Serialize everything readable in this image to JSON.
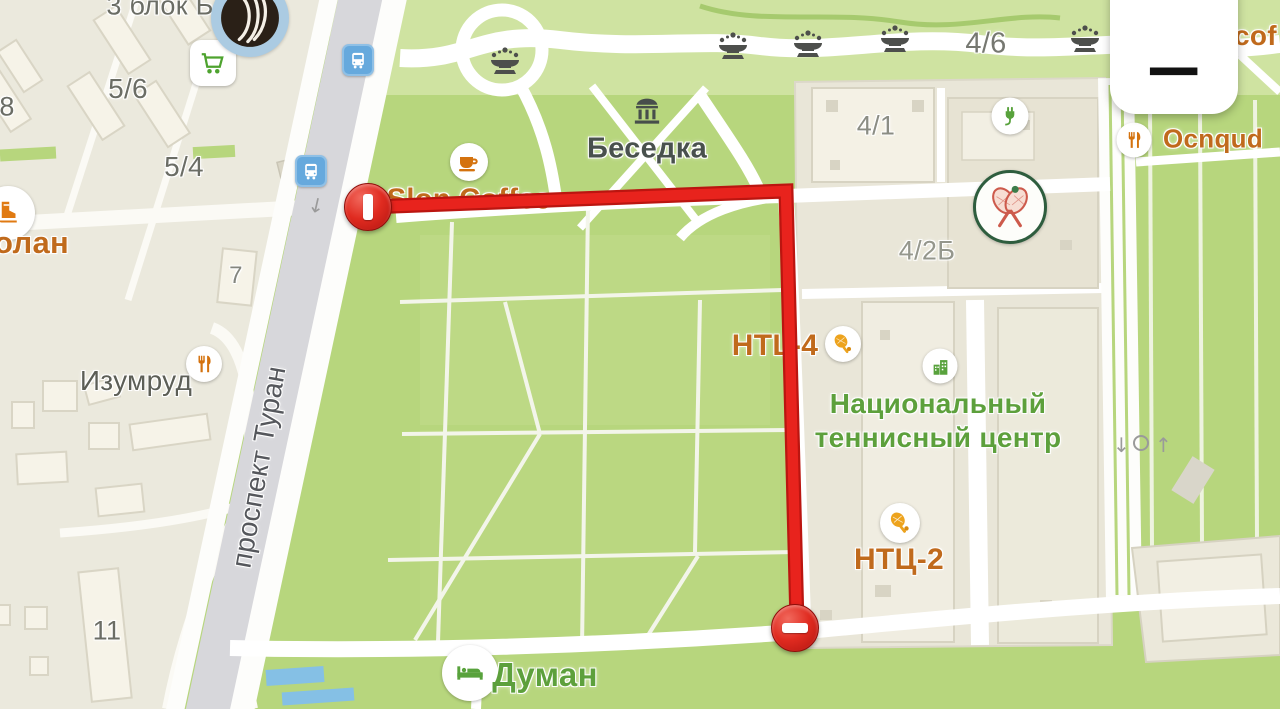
{
  "controls": {
    "zoom_out_glyph": "−"
  },
  "route": {
    "color": "#e41f1f"
  },
  "labels": {
    "block_b": "3 блок Б",
    "house_78": "78",
    "house_5_6": "5/6",
    "house_5_4": "5/4",
    "poi_olan": "олан",
    "house_7": "7",
    "izumrud": "Изумруд",
    "street_prospekt_turan": "проспект Туран",
    "house_11": "11",
    "slon_coffee": "Slon Coffee",
    "besedka": "Беседка",
    "house_4_6": "4/6",
    "house_4_1": "4/1",
    "poi_cof": "cof",
    "poi_ocnqud": "Ocnqud",
    "house_4_2b": "4/2Б",
    "htl_4": "HTL-4",
    "tennis_center_line1": "Национальный",
    "tennis_center_line2": "теннисный центр",
    "ntc_2": "НТЦ-2",
    "duman": "Думан"
  },
  "icons": {
    "arrow_down_glyph": "↓",
    "arrow_up_glyph": "↑",
    "coffee": "coffee-cup",
    "restaurant": "fork-knife",
    "hotel": "bed",
    "supermarket": "shopping-cart",
    "ice_rink": "skate",
    "tennis": "tennis-racket",
    "tennis_club": "crossed-rackets",
    "ev_charging": "plug",
    "government_building": "building",
    "fountain": "fountain",
    "pavilion": "pavilion",
    "transport_stop": "bus"
  },
  "colors": {
    "park": "#b7d67d",
    "city": "#ebe9dd",
    "road_gray": "#d7d7db",
    "route": "#e41f1f",
    "poi_orange": "#c06a1c",
    "poi_green": "#5da03c",
    "label_gray": "#6b6d65"
  }
}
